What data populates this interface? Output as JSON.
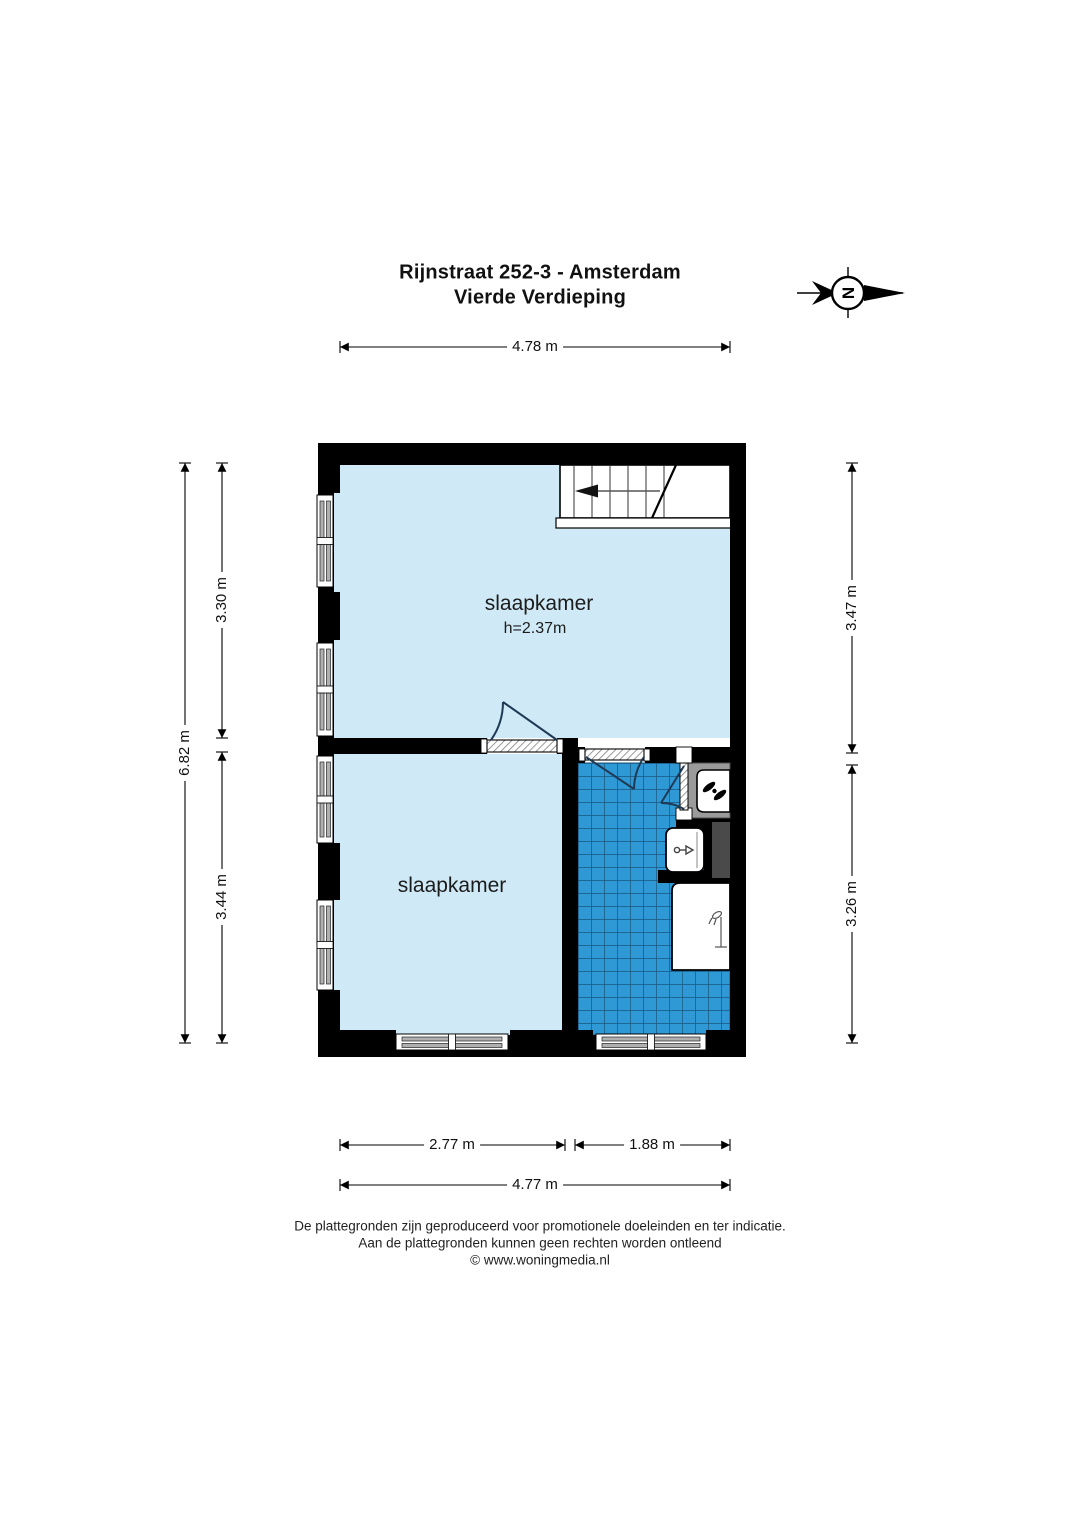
{
  "title": {
    "line1": "Rijnstraat 252-3 - Amsterdam",
    "line2": "Vierde Verdieping"
  },
  "compass": {
    "letter": "N"
  },
  "rooms": {
    "bedroom_top": {
      "label": "slaapkamer",
      "height_note": "h=2.37m"
    },
    "bedroom_bottom": {
      "label": "slaapkamer"
    }
  },
  "dimensions": {
    "top_width": "4.78 m",
    "left_total": "6.82 m",
    "left_upper": "3.30 m",
    "left_lower": "3.44 m",
    "right_upper": "3.47 m",
    "right_lower": "3.26 m",
    "bottom_left": "2.77 m",
    "bottom_right": "1.88 m",
    "bottom_total": "4.77 m"
  },
  "footer": {
    "line1": "De plattegronden zijn geproduceerd voor promotionele doeleinden en ter indicatie.",
    "line2": "Aan de plattegronden kunnen geen rechten worden ontleend",
    "line3": "© www.woningmedia.nl"
  },
  "colors": {
    "room_fill": "#cfe9f6",
    "tile_fill": "#2f99d5",
    "tile_grid": "#19567f",
    "wall": "#000000",
    "closet_gray": "#9b9b9b",
    "shaft_gray": "#4a4a4a",
    "window_bar": "#b0b0b0"
  },
  "icons": {
    "compass": "north-arrow-icon",
    "ventilation": "fan-icon",
    "washbasin": "faucet-icon",
    "shower": "shower-icon",
    "stairs": "stairs-direction-arrow"
  }
}
